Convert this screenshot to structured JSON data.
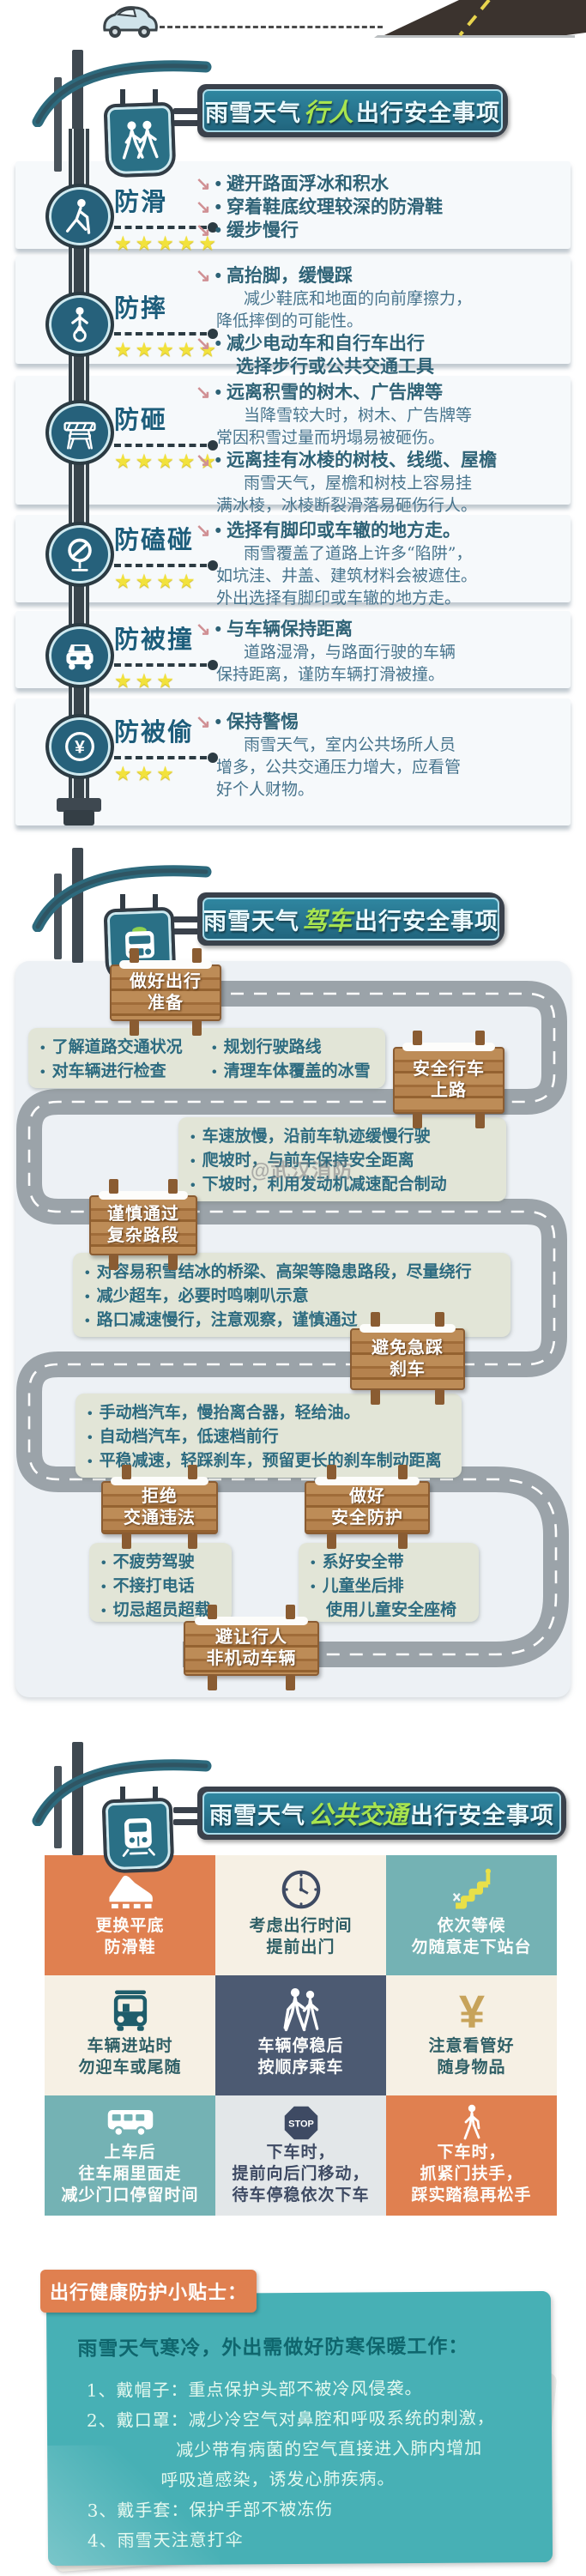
{
  "icons": {
    "arrow": "↘",
    "bullet": "•",
    "stop_label": "STOP",
    "yuan": "¥"
  },
  "colors": {
    "accent_teal": "#2a7086",
    "accent_orange": "#e08050",
    "star_yellow": "#f2e23c",
    "wood_brown": "#b5824e",
    "panel_gray": "#edf1f5",
    "navy": "#4c5a72"
  },
  "watermark": "@武汉消防",
  "headers": [
    {
      "prefix": "雨雪天气",
      "highlight": "行人",
      "suffix": "出行安全事项"
    },
    {
      "prefix": "雨雪天气",
      "highlight": "驾车",
      "suffix": "出行安全事项"
    },
    {
      "prefix": "雨雪天气",
      "highlight": "公共交通",
      "suffix": "出行安全事项"
    }
  ],
  "pedestrian": {
    "items": [
      {
        "title": "防滑",
        "rating": 5,
        "stars": "★★★★★",
        "lines": [
          "避开路面浮冰和积水",
          "穿着鞋底纹理较深的防滑鞋",
          "缓步慢行"
        ]
      },
      {
        "title": "防摔",
        "rating": 5,
        "stars": "★★★★★",
        "lines": [
          "高抬脚，缓慢踩",
          "减少鞋底和地面的向前摩擦力，",
          "降低摔倒的可能性。",
          "减少电动车和自行车出行",
          "选择步行或公共交通工具"
        ]
      },
      {
        "title": "防砸",
        "rating": 5,
        "stars": "★★★★★",
        "lines": [
          "远离积雪的树木、广告牌等",
          "当降雪较大时，树木、广告牌等",
          "常因积雪过量而坍塌易被砸伤。",
          "远离挂有冰棱的树枝、线缆、屋檐",
          "雨雪天气，屋檐和树枝上容易挂",
          "满冰棱，冰棱断裂滑落易砸伤行人。"
        ]
      },
      {
        "title": "防磕碰",
        "rating": 4,
        "stars": "★★★★",
        "lines": [
          "选择有脚印或车辙的地方走。",
          "雨雪覆盖了道路上许多“陷阱”，",
          "如坑洼、井盖、建筑材料会被遮住。",
          "外出选择有脚印或车辙的地方走。"
        ]
      },
      {
        "title": "防被撞",
        "rating": 3,
        "stars": "★★★",
        "lines": [
          "与车辆保持距离",
          "道路湿滑，与路面行驶的车辆",
          "保持距离，谨防车辆打滑被撞。"
        ]
      },
      {
        "title": "防被偷",
        "rating": 3,
        "stars": "★★★",
        "lines": [
          "保持警惕",
          "雨雪天气，室内公共场所人员",
          "增多，公共交通压力增大，应看管",
          "好个人财物。"
        ]
      }
    ]
  },
  "driving": {
    "signs": [
      [
        "做好出行",
        "准备"
      ],
      [
        "安全行车",
        "上路"
      ],
      [
        "谨慎通过",
        "复杂路段"
      ],
      [
        "避免急踩",
        "刹车"
      ],
      [
        "拒绝",
        "交通违法"
      ],
      [
        "做好",
        "安全防护"
      ],
      [
        "避让行人",
        "非机动车辆"
      ]
    ],
    "notes": [
      [
        "了解道路交通状况",
        "规划行驶路线",
        "对车辆进行检查",
        "清理车体覆盖的冰雪"
      ],
      [
        "车速放慢，沿前车轨迹缓慢行驶",
        "爬坡时，与前车保持安全距离",
        "下坡时，利用发动机减速配合制动"
      ],
      [
        "对容易积雪结冰的桥梁、高架等隐患路段，尽量绕行",
        "减少超车，必要时鸣喇叭示意",
        "路口减速慢行，注意观察，谨慎通过"
      ],
      [
        "手动档汽车，慢抬离合器，轻给油。",
        "自动档汽车，低速档前行",
        "平稳减速，轻踩刹车，预留更长的刹车制动距离"
      ],
      [
        "不疲劳驾驶",
        "不接打电话",
        "切忌超员超载"
      ],
      [
        "系好安全带",
        "儿童坐后排",
        "使用儿童安全座椅"
      ]
    ]
  },
  "transit": {
    "tiles": [
      {
        "icon": "shoe",
        "lines": [
          "更换平底",
          "防滑鞋"
        ]
      },
      {
        "icon": "clock",
        "lines": [
          "考虑出行时间",
          "提前出门"
        ]
      },
      {
        "icon": "escalator",
        "lines": [
          "依次等候",
          "勿随意走下站台"
        ]
      },
      {
        "icon": "bus-front",
        "lines": [
          "车辆进站时",
          "勿迎车或尾随"
        ]
      },
      {
        "icon": "pedestrians",
        "lines": [
          "车辆停稳后",
          "按顺序乘车"
        ]
      },
      {
        "icon": "yuan",
        "lines": [
          "注意看管好",
          "随身物品"
        ]
      },
      {
        "icon": "bus-side",
        "lines": [
          "上车后",
          "往车厢里面走",
          "减少门口停留时间"
        ]
      },
      {
        "icon": "stop",
        "lines": [
          "下车时，",
          "提前向后门移动，",
          "待车停稳依次下车"
        ]
      },
      {
        "icon": "person",
        "lines": [
          "下车时，",
          "抓紧门扶手，",
          "踩实踏稳再松手"
        ]
      }
    ]
  },
  "tips": {
    "tab": "出行健康防护小贴士：",
    "title": "雨雪天气寒冷，外出需做好防寒保暖工作：",
    "lines": [
      "1、戴帽子：重点保护头部不被冷风侵袭。",
      "2、戴口罩：减少冷空气对鼻腔和呼吸系统的刺激，",
      "减少带有病菌的空气直接进入肺内增加",
      "呼吸道感染，诱发心肺疾病。",
      "3、戴手套：保护手部不被冻伤",
      "4、雨雪天注意打伞"
    ]
  }
}
